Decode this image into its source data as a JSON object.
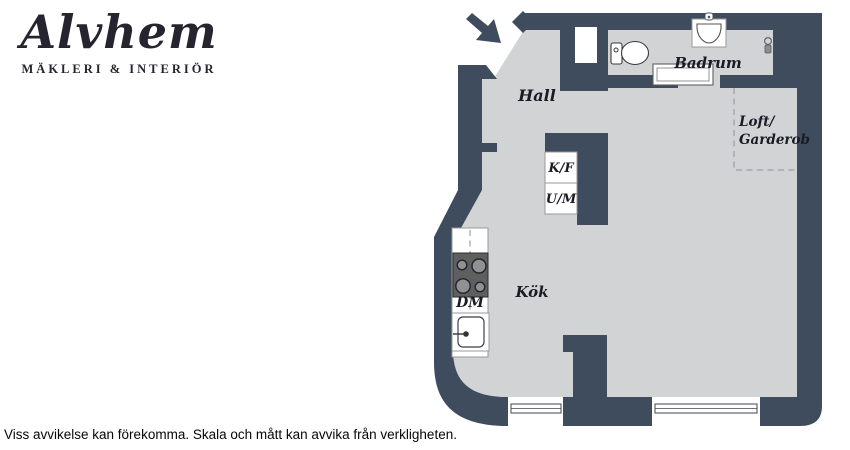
{
  "logo": {
    "brand": "Alvhem",
    "tagline": "MÄKLERI & INTERIÖR"
  },
  "floorplan": {
    "labels": {
      "hall": "Hall",
      "badrum": "Badrum",
      "loft_line1": "Loft/",
      "loft_line2": "Garderob",
      "kok": "Kök",
      "kf": "K/F",
      "um": "U/M",
      "dm": "DM"
    },
    "colors": {
      "wall": "#3e4c5d",
      "floor": "#d2d3d4",
      "label_text": "#1b1b26",
      "background": "#ffffff"
    },
    "icons": [
      "entrance-arrow-icon",
      "door-post-icon",
      "toilet-icon",
      "washbasin-icon",
      "bench-icon",
      "shower-fixture-icon",
      "stove-icon",
      "kitchen-sink-icon",
      "window-icon",
      "loft-dashed-boundary"
    ]
  },
  "disclaimer": "Viss avvikelse kan förekomma. Skala och mått kan avvika från verkligheten."
}
